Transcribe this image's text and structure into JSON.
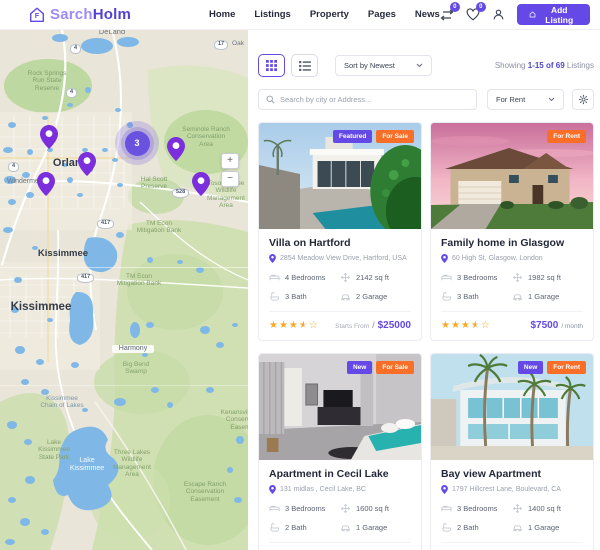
{
  "colors": {
    "accent": "#6449e7",
    "badge_orange": "#f96f28",
    "badge_purple": "#6449e7",
    "star_gold": "#f7a928",
    "pin_violet": "#7b2fdc"
  },
  "header": {
    "logo_part1": "Sarch",
    "logo_part2": "Holm",
    "nav": [
      "Home",
      "Listings",
      "Property",
      "Pages",
      "News"
    ],
    "compare_count": "0",
    "favorites_count": "0",
    "add_listing": "Add Listing"
  },
  "map": {
    "cluster_count": "3",
    "zoom_in": "+",
    "zoom_out": "−",
    "shields": [
      "4",
      "4",
      "4",
      "417",
      "417",
      "528",
      "17"
    ],
    "labels": [
      {
        "text": "DeLand"
      },
      {
        "text": "Oak"
      },
      {
        "text": "Rock Springs\nRun State\nReserve"
      },
      {
        "text": "Seminole Ranch\nConservation\nArea"
      },
      {
        "text": "Orlando"
      },
      {
        "text": "Windermere"
      },
      {
        "text": "Hal Scott\nPreserve"
      },
      {
        "text": "Tosohatchee\nWildlife\nManagement\nArea"
      },
      {
        "text": "Kissimmee"
      },
      {
        "text": "TM Econ\nMitigation Bank"
      },
      {
        "text": "TM Econ\nMitigation Bank"
      },
      {
        "text": "Kissimmee"
      },
      {
        "text": "Harmony"
      },
      {
        "text": "Big Bend\nSwamp"
      },
      {
        "text": "Kissimmee\nChain of Lakes"
      },
      {
        "text": "Lake\nKissimmee\nState Park"
      },
      {
        "text": "Lake\nKissimmee"
      },
      {
        "text": "Three Lakes\nWildlife\nManagement\nArea"
      },
      {
        "text": "Escape Ranch\nConservation\nEasement"
      },
      {
        "text": "Kenansville Prop\nConservation\nEasement"
      }
    ]
  },
  "toolbar": {
    "sort_value": "Sort by Newest",
    "showing_prefix": "Showing ",
    "showing_strong": "1-15 of 69",
    "showing_suffix": " Listings",
    "search_placeholder": "Search by city or Address...",
    "filter_value": "For Rent"
  },
  "listings": [
    {
      "title": "Villa on Hartford",
      "address": "2854 Meadow View Drive, Hartford, USA",
      "badges": [
        {
          "label": "Featured",
          "color": "#6449e7"
        },
        {
          "label": "For Sale",
          "color": "#f96f28"
        }
      ],
      "beds": "4 Bedrooms",
      "area": "2142 sq ft",
      "baths": "3 Bath",
      "garage": "2 Garage",
      "stars_full": "★★★",
      "stars_half": "★",
      "stars_empty": "☆",
      "price_note": "Starts From",
      "price_sep": "/",
      "price": "$25000",
      "price_per": null
    },
    {
      "title": "Family home in Glasgow",
      "address": "60 High St, Glasgow, London",
      "badges": [
        {
          "label": "For Rent",
          "color": "#f96f28"
        }
      ],
      "beds": "3 Bedrooms",
      "area": "1982 sq ft",
      "baths": "3 Bath",
      "garage": "1 Garage",
      "stars_full": "★★★",
      "stars_half": "★",
      "stars_empty": "☆",
      "price_note": null,
      "price_sep": null,
      "price": "$7500",
      "price_per": "/ month"
    },
    {
      "title": "Apartment in Cecil Lake",
      "address": "131 midlas , Cecil Lake, BC",
      "badges": [
        {
          "label": "New",
          "color": "#6449e7"
        },
        {
          "label": "For Sale",
          "color": "#f96f28"
        }
      ],
      "beds": "3 Bedrooms",
      "area": "1600 sq ft",
      "baths": "2 Bath",
      "garage": "1 Garage",
      "stars_full": "★★★",
      "stars_half": "★",
      "stars_empty": "☆",
      "price_note": "Starts From",
      "price_sep": "/",
      "price": "$9000",
      "price_per": null
    },
    {
      "title": "Bay view Apartment",
      "address": "1797 Hillcrest Lane, Boulevard, CA",
      "badges": [
        {
          "label": "New",
          "color": "#6449e7"
        },
        {
          "label": "For Rent",
          "color": "#f96f28"
        }
      ],
      "beds": "3 Bedrooms",
      "area": "1400 sq ft",
      "baths": "2 Bath",
      "garage": "1 Garage",
      "stars_full": "★★★",
      "stars_half": "★",
      "stars_empty": "☆",
      "price_note": null,
      "price_sep": null,
      "price": "$4000",
      "price_per": "/ month"
    }
  ]
}
